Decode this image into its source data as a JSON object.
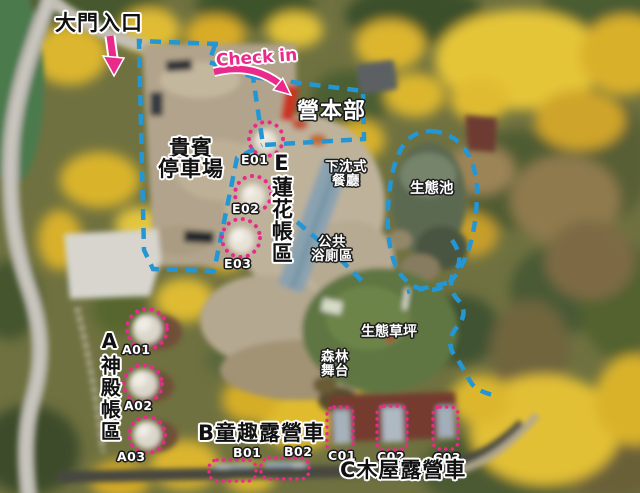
{
  "map_colors": {
    "route_line": "#2496d4",
    "site_highlight": "#ea2a8a"
  },
  "areas": {
    "gate": {
      "label": "大門入口"
    },
    "checkin": {
      "label": "Check in"
    },
    "headquarters": {
      "label": "營本部"
    },
    "vip_parking": {
      "label": "貴賓停車場",
      "line1": "貴賓",
      "line2": "停車場"
    },
    "e_lotus_tents": {
      "label": "E蓮花帳區",
      "sites": [
        "E01",
        "E02",
        "E03"
      ]
    },
    "sunken_restaurant": {
      "label": "下沈式餐廳",
      "line1": "下沈式",
      "line2": "餐廳"
    },
    "eco_pond": {
      "label": "生態池"
    },
    "public_bath": {
      "label": "公共浴廁區",
      "line1": "公共",
      "line2": "浴廁區"
    },
    "eco_lawn": {
      "label": "生態草坪"
    },
    "forest_stage": {
      "label": "森林舞台",
      "line1": "森林",
      "line2": "舞台"
    },
    "a_temple_tents": {
      "label": "A神殿帳區",
      "sites": [
        "A01",
        "A02",
        "A03"
      ]
    },
    "b_kids_campers": {
      "label": "B童趣露營車",
      "sites": [
        "B01",
        "B02"
      ]
    },
    "c_cabin_campers": {
      "label": "C木屋露營車",
      "sites": [
        "C01",
        "C02",
        "C03"
      ]
    }
  }
}
